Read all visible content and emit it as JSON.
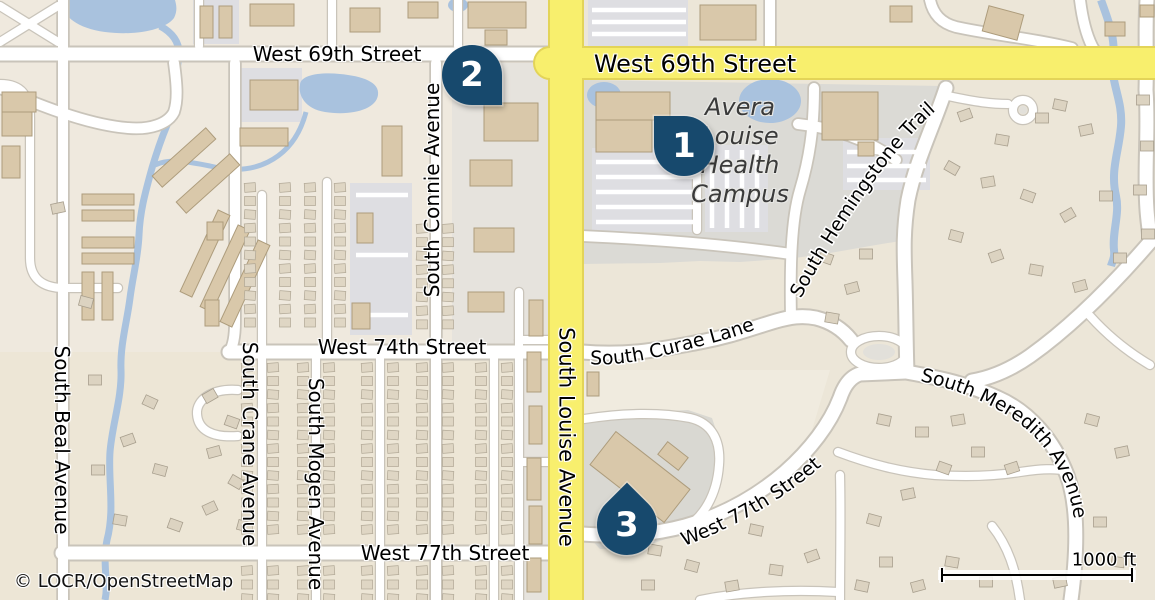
{
  "colors": {
    "marker_fill": "#17496D",
    "primary_road": "#F8EF6D",
    "water": "#A9C2DE"
  },
  "streets": {
    "w69_left": "West 69th Street",
    "w69_right": "West 69th Street",
    "w74": "West 74th Street",
    "w77_left": "West 77th Street",
    "w77_right": "West 77th Street",
    "s_louise": "South Louise Avenue",
    "s_connie": "South Connie Avenue",
    "s_beal": "South Beal Avenue",
    "s_crane": "South Crane Avenue",
    "s_mogen": "South Mogen Avenue",
    "s_curae": "South Curae Lane",
    "s_hemingstone": "South Hemingstone Trail",
    "s_meredith": "South Meredith Avenue"
  },
  "place": {
    "line1": "Avera",
    "line2": "Louise",
    "line3": "Health",
    "line4": "Campus"
  },
  "markers": {
    "pin1": "1",
    "pin2": "2",
    "pin3": "3"
  },
  "footer": {
    "attribution": "© LOCR/OpenStreetMap"
  },
  "scale": {
    "label": "1000 ft"
  }
}
